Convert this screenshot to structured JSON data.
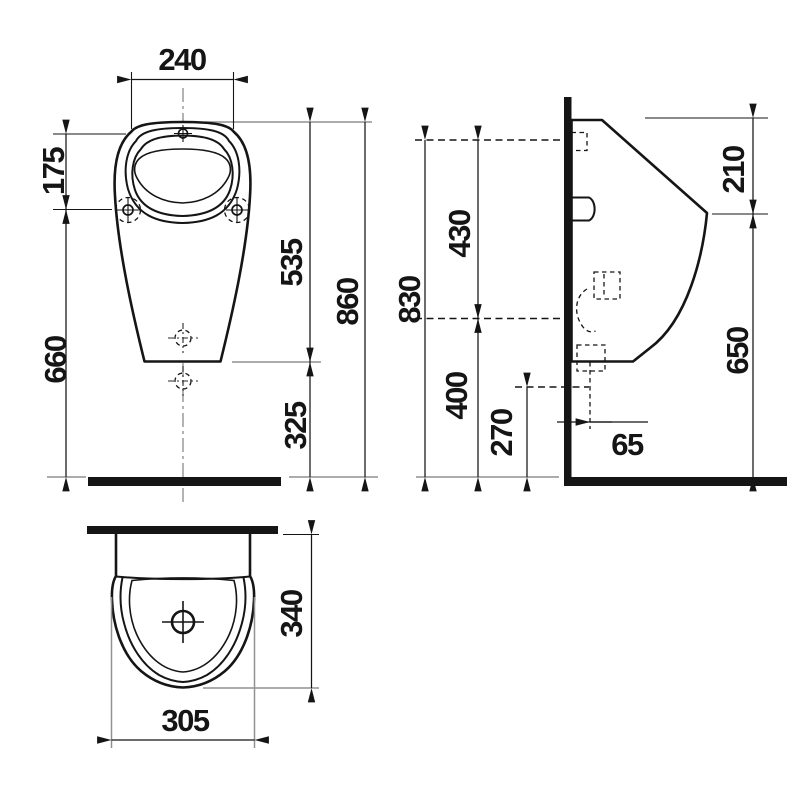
{
  "dimensions": {
    "front": {
      "top_width": "240",
      "rim_to_mounting_holes": "175",
      "mounting_holes_to_floor": "660",
      "rim_to_body_bottom": "535",
      "body_bottom_to_floor": "325",
      "overall_height": "860"
    },
    "side": {
      "inlet_axis_height": "830",
      "inlet_to_trap": "430",
      "trap_to_floor": "400",
      "outlet_to_floor": "270",
      "top_to_lip": "210",
      "lip_to_floor": "650",
      "outlet_wall_offset": "65"
    },
    "plan": {
      "depth": "340",
      "width": "305"
    }
  },
  "colors": {
    "line": "#151515",
    "extension_line": "#919191",
    "background": "#ffffff"
  }
}
